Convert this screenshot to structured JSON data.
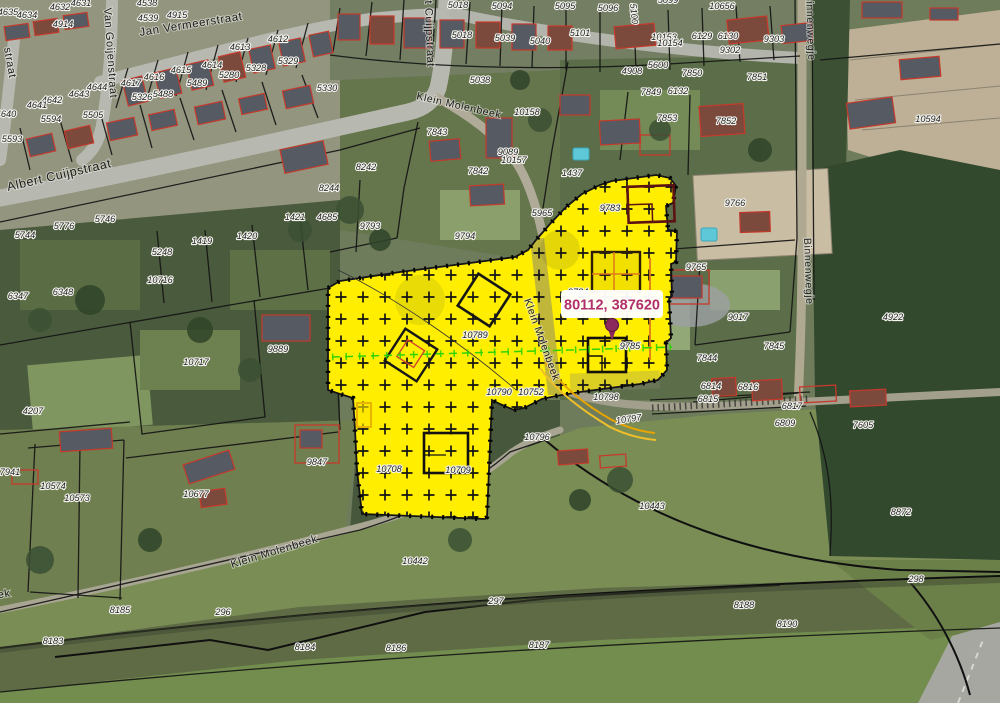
{
  "map": {
    "coordinate_readout": "80112, 387620",
    "colors": {
      "selection_yellow": "#FFEE00",
      "marker": "#8C2A5E",
      "readout_text": "#B02F6B",
      "parcel_boundary": "#141414",
      "building_outline": "#C5392B",
      "survey_line_green": "#2FD400",
      "utility_line_orange": "#E8A400"
    },
    "street_labels": [
      {
        "t": "Jan Vermeerstraat",
        "x": 140,
        "y": 36,
        "r": -9,
        "s": 11.5
      },
      {
        "t": "Van Goijenstraat",
        "x": 104,
        "y": 8,
        "r": 86,
        "s": 11
      },
      {
        "t": "straat",
        "x": 4,
        "y": 48,
        "r": 80,
        "s": 11
      },
      {
        "t": "Albert Cuijpstraat",
        "x": 8,
        "y": 191,
        "r": -13,
        "s": 12.5
      },
      {
        "t": "Albert Cuijpstraat",
        "x": 424,
        "y": -28,
        "r": 88,
        "s": 11
      },
      {
        "t": "Klein Molenbeek",
        "x": 416,
        "y": 99,
        "r": 13,
        "s": 10.5
      },
      {
        "t": "Klein Molenbeek",
        "x": 524,
        "y": 300,
        "r": 70,
        "s": 10.5
      },
      {
        "t": "Klein Molenbeek",
        "x": 232,
        "y": 568,
        "r": -17,
        "s": 11
      },
      {
        "t": "Klein Molenbeek",
        "x": -78,
        "y": 612,
        "r": -10,
        "s": 11
      },
      {
        "t": "Binnenwegje",
        "x": 806,
        "y": -6,
        "r": 88,
        "s": 10.5
      },
      {
        "t": "Binnenwegje",
        "x": 804,
        "y": 238,
        "r": 88,
        "s": 10.5
      }
    ],
    "parcel_labels": [
      {
        "t": "4635",
        "x": 8,
        "y": 15
      },
      {
        "t": "4634",
        "x": 27,
        "y": 18
      },
      {
        "t": "4632",
        "x": 60,
        "y": 10
      },
      {
        "t": "4631",
        "x": 81,
        "y": 6
      },
      {
        "t": "4914",
        "x": 63,
        "y": 27
      },
      {
        "t": "4538",
        "x": 147,
        "y": 6
      },
      {
        "t": "4539",
        "x": 148,
        "y": 21
      },
      {
        "t": "4915",
        "x": 177,
        "y": 18
      },
      {
        "t": "4612",
        "x": 278,
        "y": 42
      },
      {
        "t": "4613",
        "x": 240,
        "y": 50
      },
      {
        "t": "4614",
        "x": 212,
        "y": 68
      },
      {
        "t": "4615",
        "x": 181,
        "y": 73
      },
      {
        "t": "4616",
        "x": 154,
        "y": 80
      },
      {
        "t": "4617",
        "x": 131,
        "y": 86
      },
      {
        "t": "5329",
        "x": 288,
        "y": 64
      },
      {
        "t": "5328",
        "x": 256,
        "y": 71
      },
      {
        "t": "5280",
        "x": 229,
        "y": 78
      },
      {
        "t": "5489",
        "x": 197,
        "y": 86
      },
      {
        "t": "5330",
        "x": 327,
        "y": 91
      },
      {
        "t": "5326",
        "x": 142,
        "y": 100
      },
      {
        "t": "5488",
        "x": 163,
        "y": 97
      },
      {
        "t": "4644",
        "x": 97,
        "y": 90
      },
      {
        "t": "4643",
        "x": 79,
        "y": 97
      },
      {
        "t": "4642",
        "x": 52,
        "y": 103
      },
      {
        "t": "4641",
        "x": 37,
        "y": 108
      },
      {
        "t": "4640",
        "x": 6,
        "y": 117
      },
      {
        "t": "5594",
        "x": 51,
        "y": 122
      },
      {
        "t": "5505",
        "x": 93,
        "y": 118
      },
      {
        "t": "5593",
        "x": 12,
        "y": 142
      },
      {
        "t": "5744",
        "x": 25,
        "y": 238
      },
      {
        "t": "5746",
        "x": 105,
        "y": 222
      },
      {
        "t": "5776",
        "x": 64,
        "y": 229
      },
      {
        "t": "8244",
        "x": 329,
        "y": 191
      },
      {
        "t": "4685",
        "x": 327,
        "y": 220
      },
      {
        "t": "1421",
        "x": 295,
        "y": 220
      },
      {
        "t": "1419",
        "x": 202,
        "y": 244
      },
      {
        "t": "1420",
        "x": 247,
        "y": 239
      },
      {
        "t": "5248",
        "x": 162,
        "y": 255
      },
      {
        "t": "10716",
        "x": 160,
        "y": 283
      },
      {
        "t": "10717",
        "x": 196,
        "y": 365
      },
      {
        "t": "6347",
        "x": 18,
        "y": 299
      },
      {
        "t": "6348",
        "x": 63,
        "y": 295
      },
      {
        "t": "4207",
        "x": 33,
        "y": 414
      },
      {
        "t": "7941",
        "x": 10,
        "y": 475
      },
      {
        "t": "10574",
        "x": 53,
        "y": 489
      },
      {
        "t": "10573",
        "x": 77,
        "y": 501
      },
      {
        "t": "10677",
        "x": 196,
        "y": 497
      },
      {
        "t": "9847",
        "x": 317,
        "y": 465
      },
      {
        "t": "9889",
        "x": 278,
        "y": 352
      },
      {
        "t": "9793",
        "x": 370,
        "y": 229
      },
      {
        "t": "9794",
        "x": 465,
        "y": 239
      },
      {
        "t": "8242",
        "x": 366,
        "y": 170
      },
      {
        "t": "7843",
        "x": 437,
        "y": 135
      },
      {
        "t": "7842",
        "x": 478,
        "y": 174
      },
      {
        "t": "9089",
        "x": 508,
        "y": 155
      },
      {
        "t": "10157",
        "x": 514,
        "y": 163
      },
      {
        "t": "10158",
        "x": 527,
        "y": 115
      },
      {
        "t": "1437",
        "x": 572,
        "y": 176
      },
      {
        "t": "5965",
        "x": 542,
        "y": 216
      },
      {
        "t": "5038",
        "x": 480,
        "y": 83
      },
      {
        "t": "5018",
        "x": 458,
        "y": 8
      },
      {
        "t": "5018",
        "x": 462,
        "y": 38
      },
      {
        "t": "5094",
        "x": 502,
        "y": 9
      },
      {
        "t": "5039",
        "x": 505,
        "y": 41
      },
      {
        "t": "5040",
        "x": 540,
        "y": 44
      },
      {
        "t": "5095",
        "x": 565,
        "y": 9
      },
      {
        "t": "5096",
        "x": 608,
        "y": 11
      },
      {
        "t": "5101",
        "x": 580,
        "y": 36
      },
      {
        "t": "5100",
        "x": 631,
        "y": 14,
        "r": 85
      },
      {
        "t": "5099",
        "x": 668,
        "y": 3
      },
      {
        "t": "10656",
        "x": 722,
        "y": 9
      },
      {
        "t": "6129",
        "x": 702,
        "y": 39
      },
      {
        "t": "6130",
        "x": 728,
        "y": 39
      },
      {
        "t": "9302",
        "x": 730,
        "y": 53
      },
      {
        "t": "9303",
        "x": 774,
        "y": 42
      },
      {
        "t": "10153",
        "x": 664,
        "y": 40
      },
      {
        "t": "10154",
        "x": 670,
        "y": 46
      },
      {
        "t": "5600",
        "x": 658,
        "y": 68
      },
      {
        "t": "4908",
        "x": 632,
        "y": 74
      },
      {
        "t": "7850",
        "x": 692,
        "y": 76
      },
      {
        "t": "7851",
        "x": 757,
        "y": 80
      },
      {
        "t": "7852",
        "x": 726,
        "y": 124
      },
      {
        "t": "7849",
        "x": 651,
        "y": 95
      },
      {
        "t": "6132",
        "x": 678,
        "y": 94
      },
      {
        "t": "7853",
        "x": 667,
        "y": 121
      },
      {
        "t": "10594",
        "x": 928,
        "y": 122
      },
      {
        "t": "9766",
        "x": 735,
        "y": 206
      },
      {
        "t": "9765",
        "x": 696,
        "y": 270
      },
      {
        "t": "9783",
        "x": 610,
        "y": 211
      },
      {
        "t": "9784",
        "x": 578,
        "y": 295
      },
      {
        "t": "9785",
        "x": 630,
        "y": 349
      },
      {
        "t": "9017",
        "x": 738,
        "y": 320
      },
      {
        "t": "7845",
        "x": 774,
        "y": 349
      },
      {
        "t": "7844",
        "x": 707,
        "y": 361
      },
      {
        "t": "6814",
        "x": 711,
        "y": 389
      },
      {
        "t": "6815",
        "x": 708,
        "y": 402
      },
      {
        "t": "6816",
        "x": 748,
        "y": 390
      },
      {
        "t": "6817",
        "x": 792,
        "y": 409
      },
      {
        "t": "6809",
        "x": 785,
        "y": 426
      },
      {
        "t": "7605",
        "x": 863,
        "y": 428
      },
      {
        "t": "8872",
        "x": 901,
        "y": 515
      },
      {
        "t": "4922",
        "x": 893,
        "y": 320
      },
      {
        "t": "10443",
        "x": 652,
        "y": 509
      },
      {
        "t": "10442",
        "x": 415,
        "y": 564
      },
      {
        "t": "297",
        "x": 496,
        "y": 604
      },
      {
        "t": "296",
        "x": 223,
        "y": 615
      },
      {
        "t": "298",
        "x": 916,
        "y": 582
      },
      {
        "t": "8185",
        "x": 120,
        "y": 613
      },
      {
        "t": "8183",
        "x": 53,
        "y": 644
      },
      {
        "t": "8184",
        "x": 305,
        "y": 650
      },
      {
        "t": "8186",
        "x": 396,
        "y": 651
      },
      {
        "t": "8187",
        "x": 539,
        "y": 648
      },
      {
        "t": "8188",
        "x": 744,
        "y": 608
      },
      {
        "t": "8190",
        "x": 787,
        "y": 627
      },
      {
        "t": "10708",
        "x": 389,
        "y": 472
      },
      {
        "t": "10709",
        "x": 458,
        "y": 473
      },
      {
        "t": "10752",
        "x": 531,
        "y": 395
      },
      {
        "t": "10790",
        "x": 499,
        "y": 395
      },
      {
        "t": "10798",
        "x": 606,
        "y": 400
      },
      {
        "t": "10797",
        "x": 629,
        "y": 422,
        "r": -8
      },
      {
        "t": "10796",
        "x": 537,
        "y": 440
      },
      {
        "t": "10789",
        "x": 475,
        "y": 338
      }
    ]
  }
}
